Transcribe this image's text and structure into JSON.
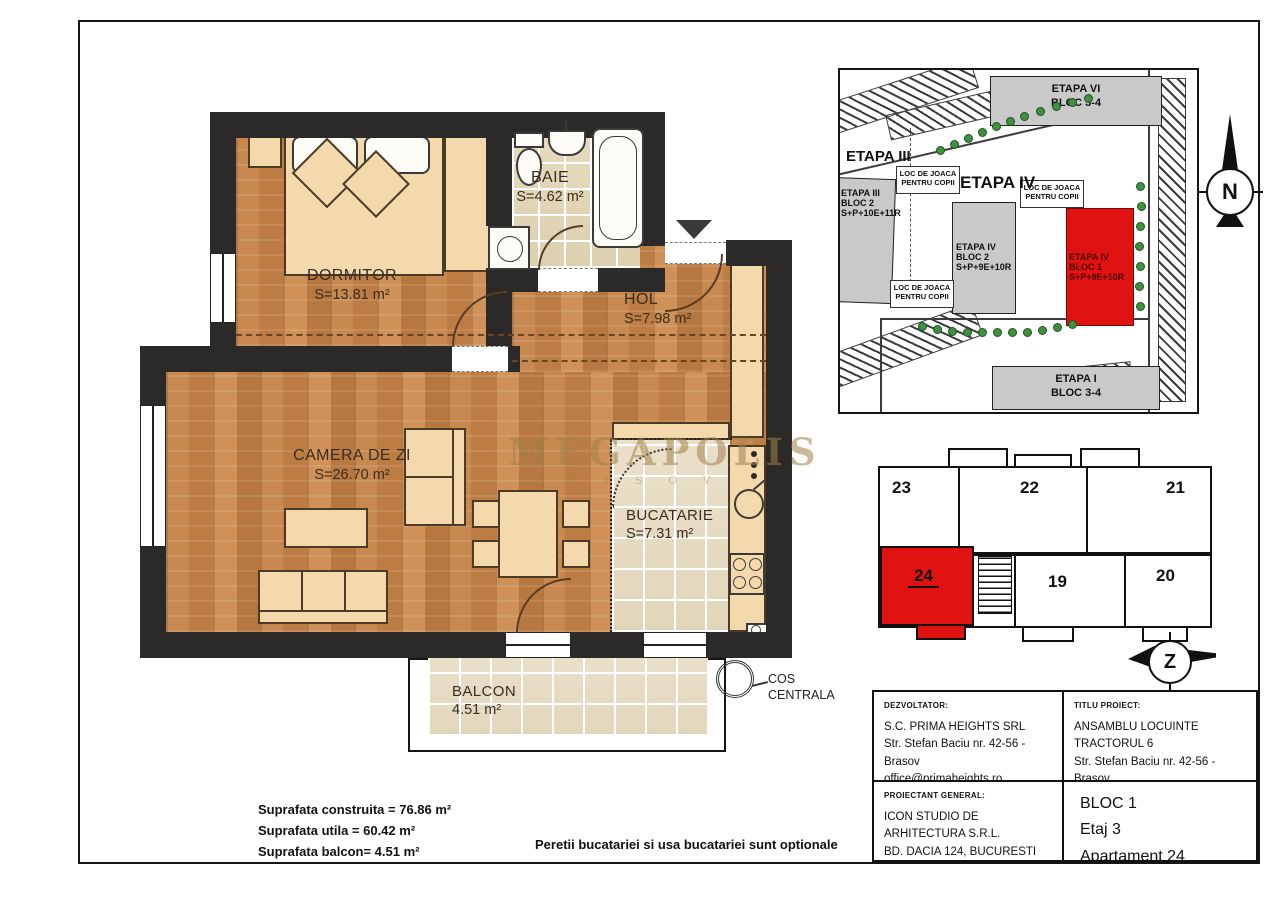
{
  "watermark": {
    "line1": "MEGAPOLIS",
    "line2": "B R A S O V"
  },
  "floor_plan": {
    "rooms": {
      "dormitor": {
        "name": "DORMITOR",
        "area": "S=13.81 m²"
      },
      "baie": {
        "name": "BAIE",
        "area": "S=4.62 m²"
      },
      "hol": {
        "name": "HOL",
        "area": "S=7.98 m²"
      },
      "camera_de_zi": {
        "name": "CAMERA DE ZI",
        "area": "S=26.70 m²"
      },
      "bucatarie": {
        "name": "BUCATARIE",
        "area": "S=7.31 m²"
      },
      "balcon": {
        "name": "BALCON",
        "area": "4.51 m²"
      }
    },
    "cos_centrala": {
      "line1": "COS",
      "line2": "CENTRALA"
    }
  },
  "site_plan": {
    "labels": {
      "etapa_iii": "ETAPA III",
      "etapa_iv": "ETAPA IV"
    },
    "playground": {
      "line1": "LOC DE JOACA",
      "line2": "PENTRU COPII"
    },
    "buildings": {
      "etapa_vi": {
        "line1": "ETAPA VI",
        "line2": "BLOC 3-4"
      },
      "etapa_iii_bloc2": {
        "line1": "ETAPA III",
        "line2": "BLOC 2",
        "line3": "S+P+10E+11R"
      },
      "etapa_iv_bloc2": {
        "line1": "ETAPA IV",
        "line2": "BLOC 2",
        "line3": "S+P+9E+10R"
      },
      "etapa_iv_bloc1": {
        "line1": "ETAPA IV",
        "line2": "BLOC 1",
        "line3": "S+P+9E+10R"
      },
      "etapa_i": {
        "line1": "ETAPA I",
        "line2": "BLOC 3-4"
      }
    }
  },
  "compass": {
    "north": "N",
    "z": "Z"
  },
  "floor_diagram": {
    "apartments": [
      {
        "label": "23"
      },
      {
        "label": "22"
      },
      {
        "label": "21"
      },
      {
        "label": "24"
      },
      {
        "label": "19"
      },
      {
        "label": "20"
      }
    ]
  },
  "title_block": {
    "developer_caption": "DEZVOLTATOR:",
    "developer_lines": [
      "S.C. PRIMA HEIGHTS SRL",
      "Str. Stefan Baciu nr. 42-56 - Brasov",
      "office@primaheights.ro"
    ],
    "project_caption": "TITLU PROIECT:",
    "project_lines": [
      "ANSAMBLU LOCUINTE",
      "TRACTORUL 6",
      "Str. Stefan Baciu nr. 42-56 - Brasov"
    ],
    "designer_caption": "PROIECTANT GENERAL:",
    "designer_lines": [
      "ICON STUDIO DE ARHITECTURA S.R.L.",
      "BD. DACIA 124, BUCURESTI"
    ],
    "unit_lines": [
      "BLOC 1",
      "Etaj 3",
      "Apartament 24"
    ]
  },
  "summary": {
    "lines": [
      "Suprafata construita = 76.86 m²",
      "Suprafata utila = 60.42 m²",
      "Suprafata balcon= 4.51 m²"
    ],
    "note": "Peretii bucatariei si usa bucatariei sunt optionale"
  },
  "colors": {
    "highlight_red": "#e01212",
    "wall_dark": "#2c2a28",
    "wood": "#c88950",
    "tile_beige": "#e6dabd",
    "furniture_tan": "#f4d9ad",
    "tree_green": "#3f9140",
    "watermark_gold": "#9e8248"
  }
}
